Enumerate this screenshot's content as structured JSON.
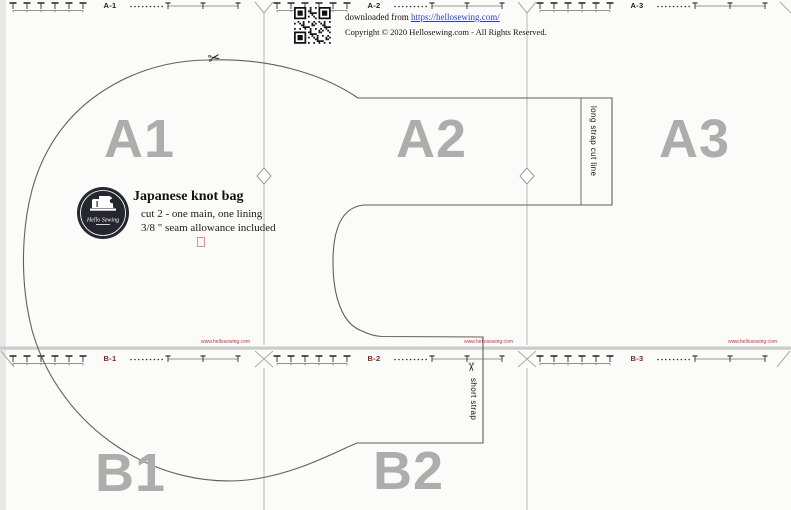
{
  "header": {
    "qr_icon": "qr-code-icon",
    "downloaded_prefix": "downloaded from ",
    "downloaded_link": "https://hellosewing.com/",
    "copyright": "Copyright © 2020 Hellosewing.com - All Rights Reserved."
  },
  "pages": {
    "a1": {
      "ruler_label": "A-1",
      "big_letter": "A1",
      "watermark": "www.hellosewing.com"
    },
    "a2": {
      "ruler_label": "A-2",
      "big_letter": "A2",
      "watermark": "www.hellosewing.com"
    },
    "a3": {
      "ruler_label": "A-3",
      "big_letter": "A3",
      "watermark": "www.hellosewing.com"
    },
    "b1": {
      "ruler_label": "B-1",
      "big_letter": "B1"
    },
    "b2": {
      "ruler_label": "B-2",
      "big_letter": "B2"
    },
    "b3": {
      "ruler_label": "B-3"
    }
  },
  "pattern_label": {
    "logo_name": "hello-sewing-logo",
    "logo_text": "Hello Sewing",
    "title": "Japanese knot bag",
    "line1": "cut 2 - one main, one lining",
    "line2": "3/8 \" seam allowance included"
  },
  "annotations": {
    "long_strap": "long strap cut line",
    "short_strap": "short strap",
    "scissors_icon": "✂"
  },
  "colors": {
    "page_letter": "#adadad",
    "b_ruler_label": "#8b2121",
    "watermark_red": "#cc3333",
    "link_blue": "#2b3fc4",
    "outline_gray": "#5f5f5f",
    "boundary_gray": "#b9b9b9"
  }
}
